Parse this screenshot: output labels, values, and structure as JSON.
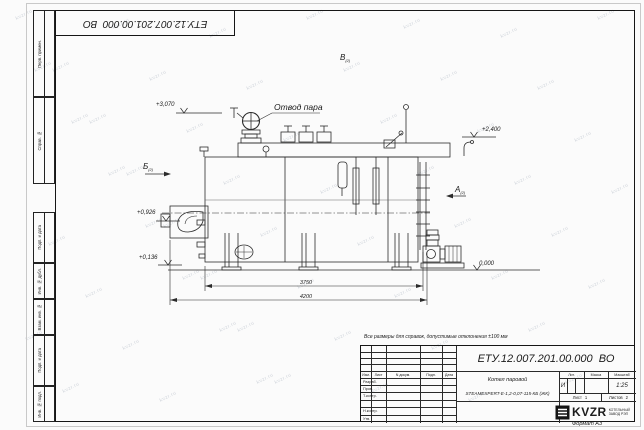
{
  "sheet": {
    "designation": "ЕТУ.12.007.201.00.000  ВО",
    "format_label": "Формат А3",
    "watermark": "kvzr.ru",
    "note": "Все размеры для справок, допустимые отклонения ±100 мм"
  },
  "left_margin": {
    "blocks": [
      "Перв. примен.",
      "Справ. №",
      "Подп. и дата",
      "Инв. № дубл.",
      "Взам. инв. №",
      "Подп. и дата",
      "Инв. № подл."
    ]
  },
  "drawing": {
    "steam_outlet_label": "Отвод пара",
    "elevations": {
      "top": "+3,070",
      "plate": "+2,400",
      "mid": "+0,926",
      "low": "+0,136",
      "ground": "0,000"
    },
    "views": {
      "a": "А",
      "a_sub": "(2)",
      "b": "Б",
      "b_sub": "(2)",
      "v": "В",
      "v_sub": "(2)"
    },
    "dimensions": {
      "inner": "3750",
      "outer": "4200"
    }
  },
  "title_block": {
    "name_line1": "Котел паровой",
    "name_line2": "STEAMEXPERT-Е-1,2-0,07-115-КБ (ЖК)",
    "headers": {
      "izm": "Изм.",
      "list": "Лист",
      "doc": "N докум.",
      "sign": "Подп.",
      "date": "Дата",
      "lit": "Лит.",
      "mass": "Масса",
      "scale": "Масштаб"
    },
    "rows": {
      "r1": "Разраб.",
      "r2": "Пров.",
      "r3": "Т.контр.",
      "r4": "Н.контр.",
      "r5": "Утв."
    },
    "lit_value": "И",
    "scale_value": "1:25",
    "sheet_label": "Лист",
    "sheet_value": "1",
    "sheets_label": "Листов",
    "sheets_value": "2",
    "logo": {
      "text": "KVZR",
      "sub1": "КОТЕЛЬНЫЙ",
      "sub2": "ЗАВОД РЭП"
    }
  }
}
